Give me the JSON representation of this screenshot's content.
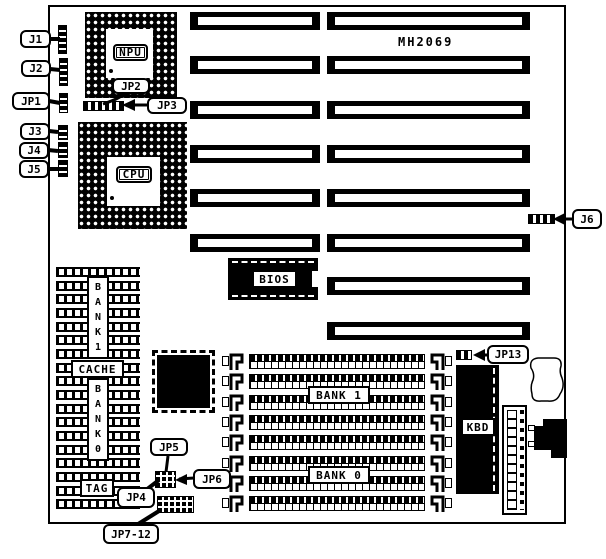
{
  "board": {
    "model": "MH2069"
  },
  "colors": {
    "ink": "#000000",
    "paper": "#ffffff"
  },
  "chips": {
    "npu": "NPU",
    "cpu": "CPU",
    "bios": "BIOS",
    "kbd": "KBD",
    "cache": "CACHE",
    "tag": "TAG",
    "bank1_vertical": "BANK1",
    "bank0_vertical": "BANK0"
  },
  "simm": {
    "bank1": "BANK 1",
    "bank0": "BANK 0"
  },
  "callouts": {
    "j1": "J1",
    "j2": "J2",
    "jp1": "JP1",
    "j3": "J3",
    "j4": "J4",
    "j5": "J5",
    "jp2": "JP2",
    "jp3": "JP3",
    "j6": "J6",
    "jp13": "JP13",
    "jp5": "JP5",
    "jp6": "JP6",
    "jp4": "JP4",
    "jp7_12": "JP7-12"
  }
}
